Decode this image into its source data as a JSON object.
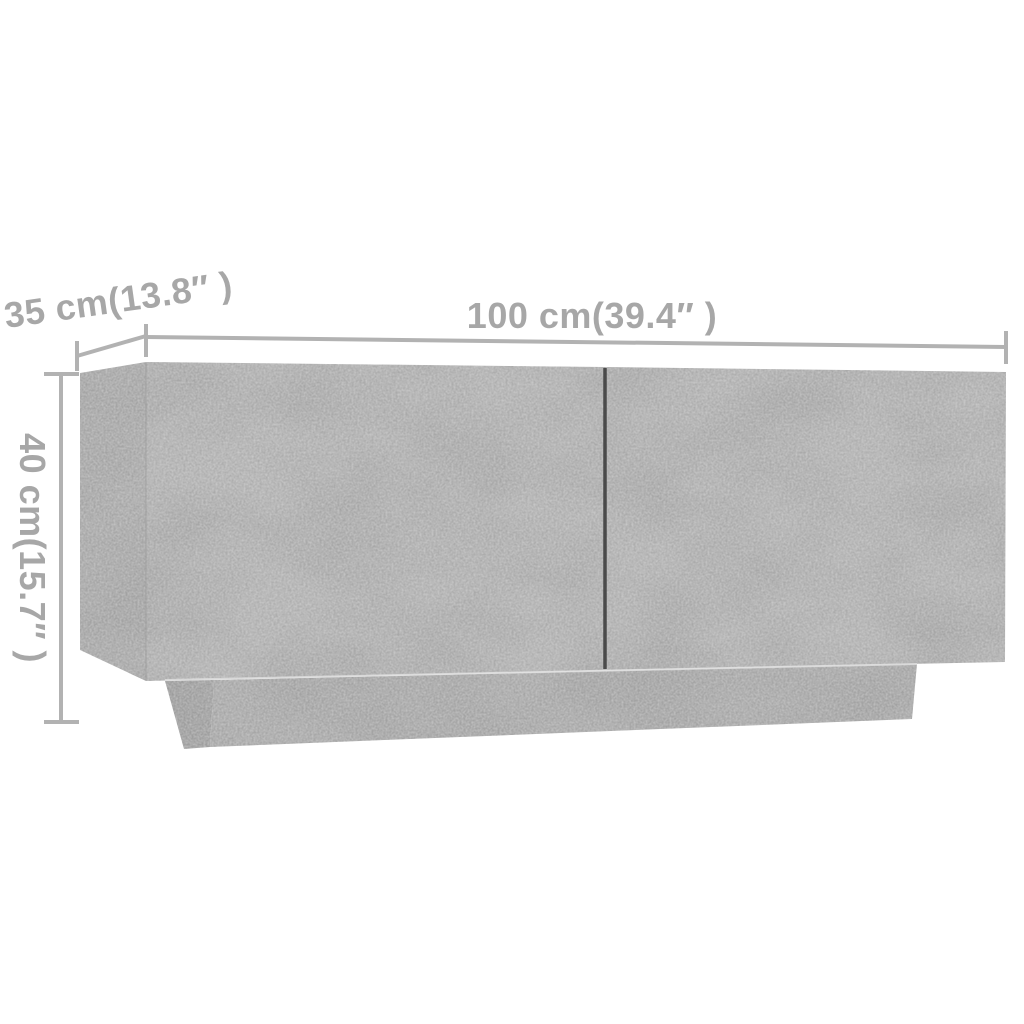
{
  "image": {
    "background": "#ffffff",
    "colors": {
      "dimension_line": "#b2b2b2",
      "dimension_label": "#a7a7a7",
      "door_front": "#b4b4b4",
      "side_panel": "#acacac",
      "plinth_front": "#ababab",
      "plinth_side": "#a1a1a1",
      "door_gap": "#4a4a4a",
      "seam_highlight": "#dedede",
      "panel_edge": "#9b9b9b"
    }
  },
  "dimensions": {
    "width_label": "100 cm(39.4″ )",
    "depth_label": "35 cm(13.8″ )",
    "height_label": "40 cm(15.7″ )"
  }
}
